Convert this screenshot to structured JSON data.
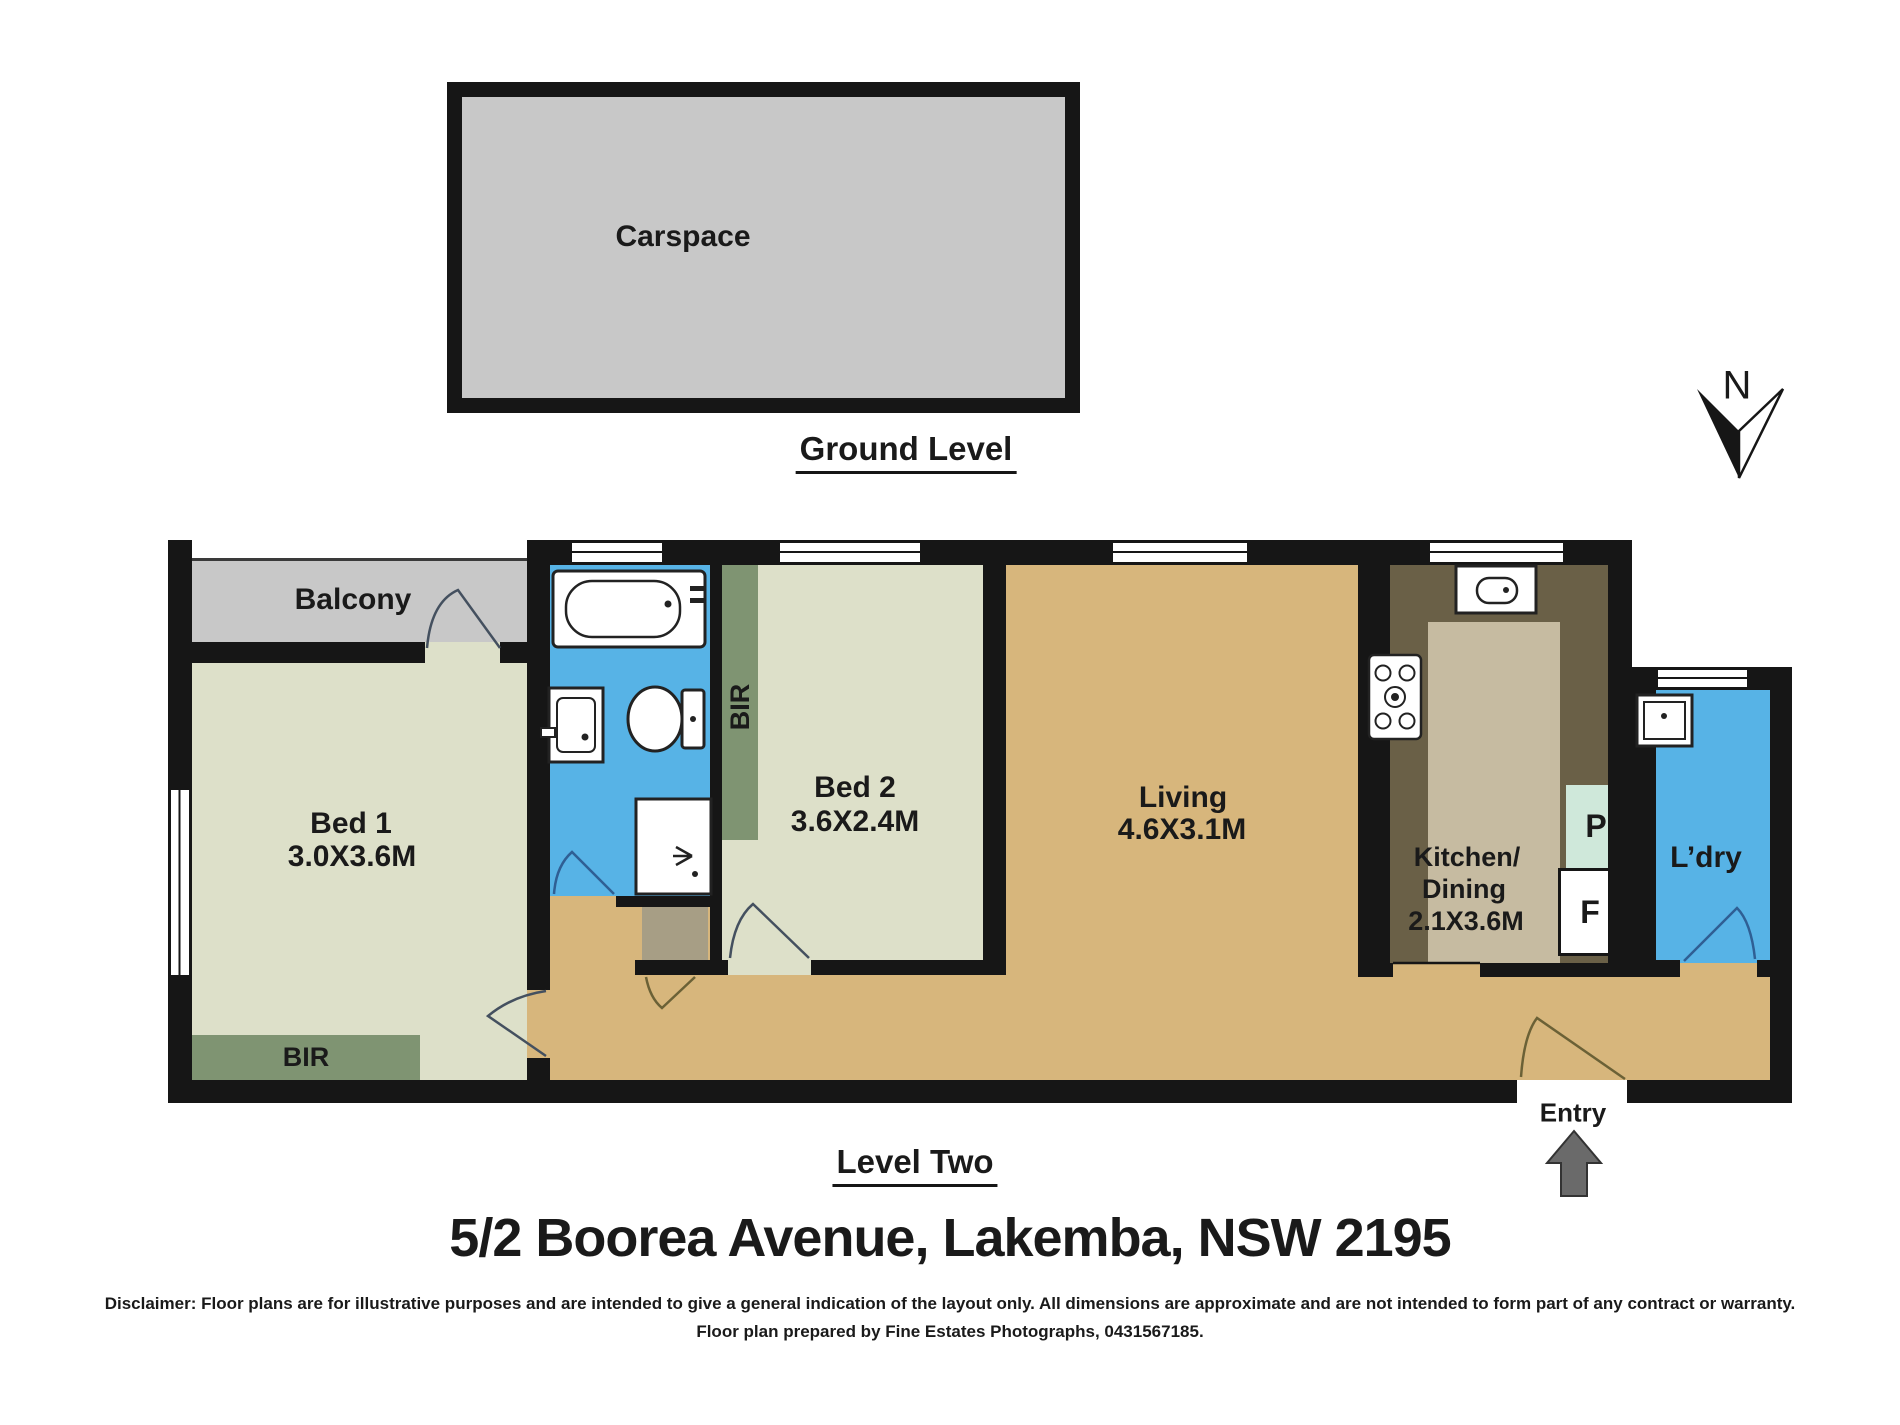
{
  "colors": {
    "wall": "#161616",
    "outdoor-gray": "#c8c8c8",
    "bedroom-sage": "#dde0c9",
    "wardrobe-green": "#7f9472",
    "wet-blue": "#57b3e6",
    "floor-tan": "#d7b67c",
    "kitchen-olive": "#6a6047",
    "counter-taupe": "#c6bba1",
    "pantry-mint": "#cfe8da",
    "cupboard-khaki": "#a79e85",
    "ink": "#1a1a1a",
    "door-swing": "#44505f",
    "door-swing-olive": "#6b6136",
    "entry-arrow-gray": "#6a6a6a"
  },
  "ground_level": {
    "room": "Carspace",
    "caption": "Ground Level"
  },
  "level_two": {
    "caption": "Level Two",
    "compass": {
      "label": "N"
    },
    "rooms": {
      "balcony": {
        "label": "Balcony"
      },
      "bed1": {
        "label": "Bed 1",
        "dims": "3.0X3.6M",
        "wardrobe": "BIR"
      },
      "bed2": {
        "label": "Bed 2",
        "dims": "3.6X2.4M",
        "wardrobe": "BIR"
      },
      "living": {
        "label": "Living",
        "dims": "4.6X3.1M"
      },
      "kitchen": {
        "label_line1": "Kitchen/",
        "label_line2": "Dining",
        "dims": "2.1X3.6M",
        "pantry": "P",
        "fridge": "F"
      },
      "laundry": {
        "label": "L’dry"
      },
      "entry": {
        "label": "Entry"
      }
    }
  },
  "address": "5/2 Boorea Avenue, Lakemba, NSW 2195",
  "disclaimer": {
    "line1": "Disclaimer: Floor plans are for illustrative purposes and are intended to give a general indication of the layout only. All dimensions are approximate and are not intended to form part of any contract or warranty.",
    "line2": "Floor plan prepared by Fine Estates Photographs, 0431567185."
  }
}
